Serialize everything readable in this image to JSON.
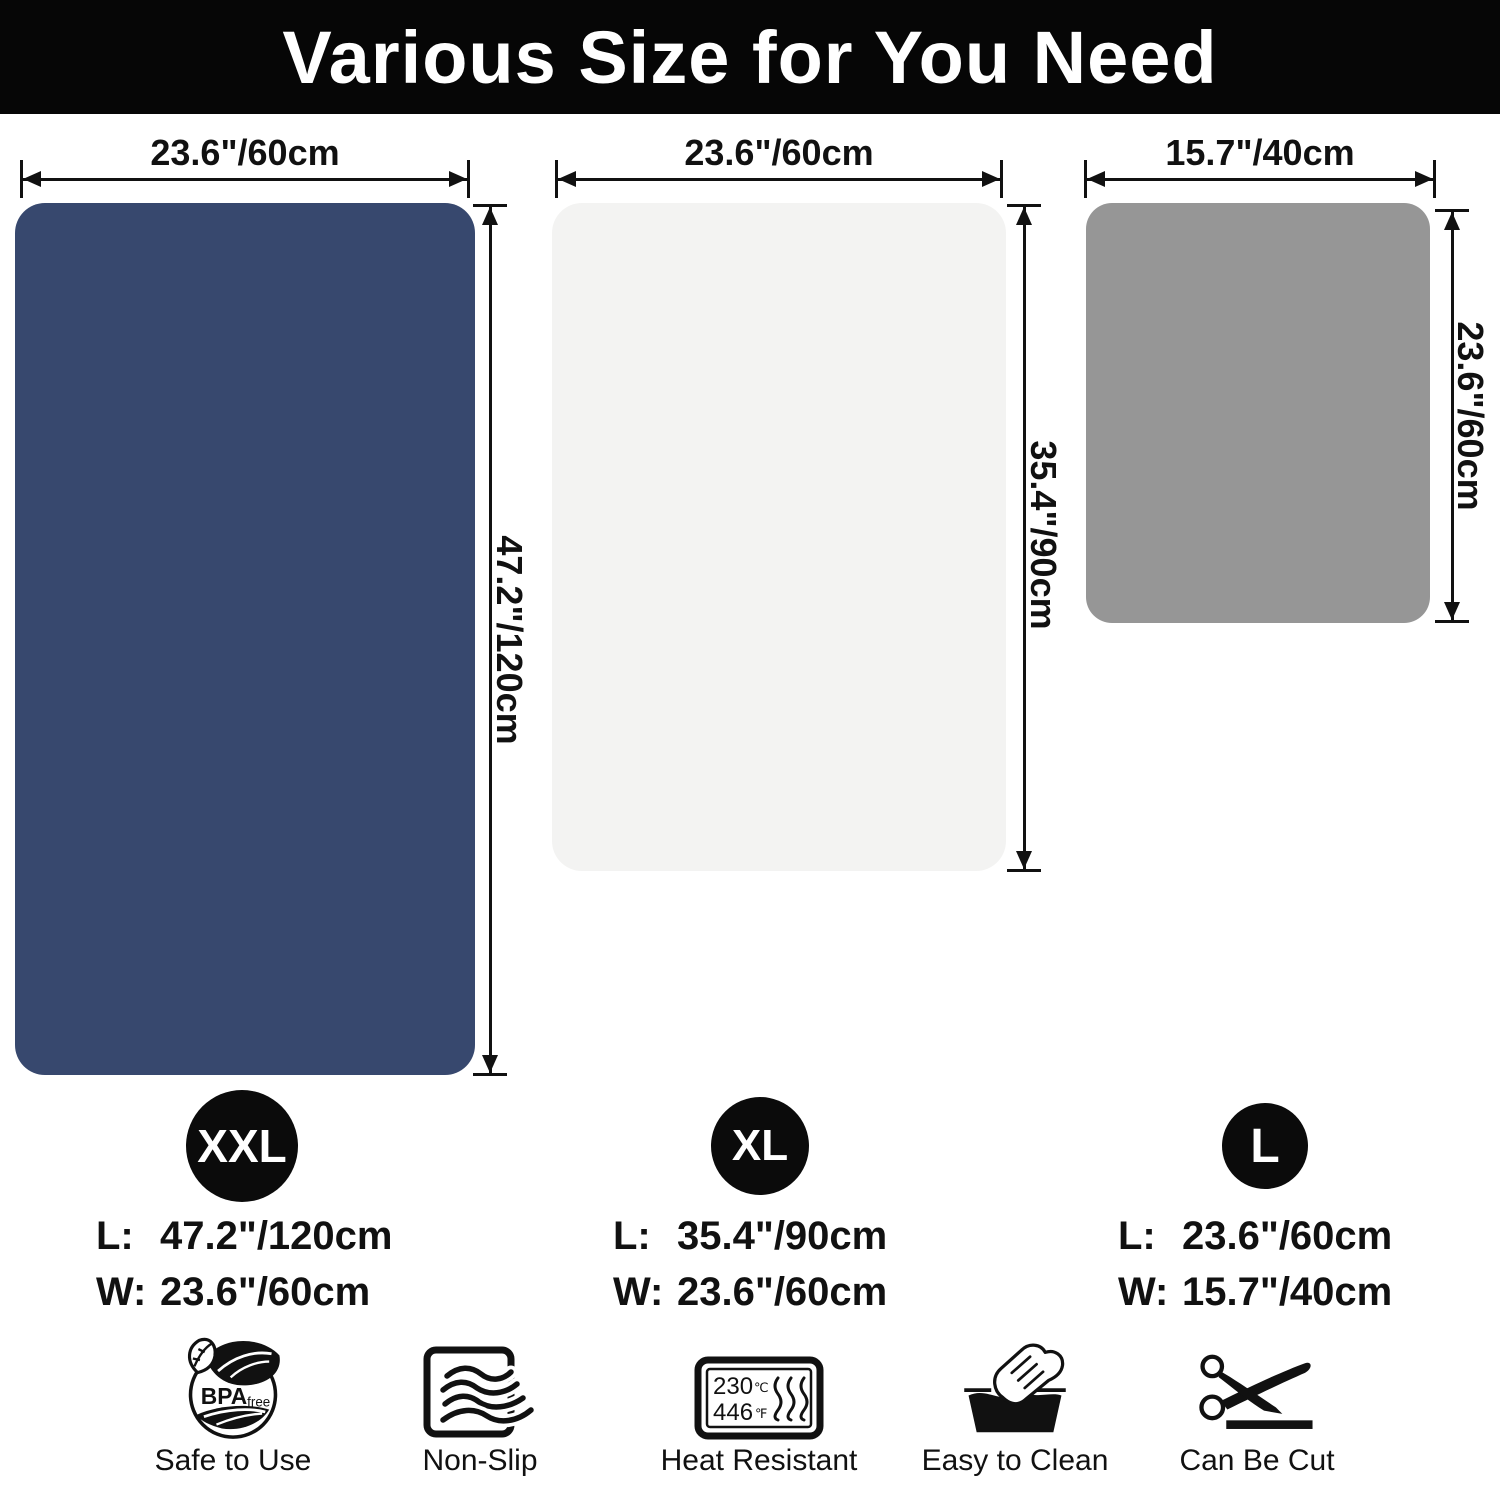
{
  "header": {
    "title": "Various Size for You Need"
  },
  "mats": [
    {
      "badge": "XXL",
      "color": "#37486e",
      "top_dimension": "23.6\"/60cm",
      "side_dimension": "47.2\"/120cm",
      "length_label": "L:",
      "length_value": "47.2\"/120cm",
      "width_label": "W:",
      "width_value": "23.6\"/60cm"
    },
    {
      "badge": "XL",
      "color": "#f3f3f2",
      "top_dimension": "23.6\"/60cm",
      "side_dimension": "35.4\"/90cm",
      "length_label": "L:",
      "length_value": "35.4\"/90cm",
      "width_label": "W:",
      "width_value": "23.6\"/60cm"
    },
    {
      "badge": "L",
      "color": "#969696",
      "top_dimension": "15.7\"/40cm",
      "side_dimension": "23.6\"/60cm",
      "length_label": "L:",
      "length_value": "23.6\"/60cm",
      "width_label": "W:",
      "width_value": "15.7\"/40cm"
    }
  ],
  "features": [
    {
      "label": "Safe to Use",
      "icon_text_big": "BPA",
      "icon_text_small": "free"
    },
    {
      "label": "Non-Slip"
    },
    {
      "label": "Heat Resistant",
      "temp_c": "230",
      "unit_c": "℃",
      "temp_f": "446",
      "unit_f": "℉"
    },
    {
      "label": "Easy to Clean"
    },
    {
      "label": "Can Be Cut"
    }
  ],
  "colors": {
    "header_bg": "#060606",
    "navy": "#37486e",
    "light": "#f3f3f2",
    "gray": "#969696",
    "ink": "#111111"
  }
}
